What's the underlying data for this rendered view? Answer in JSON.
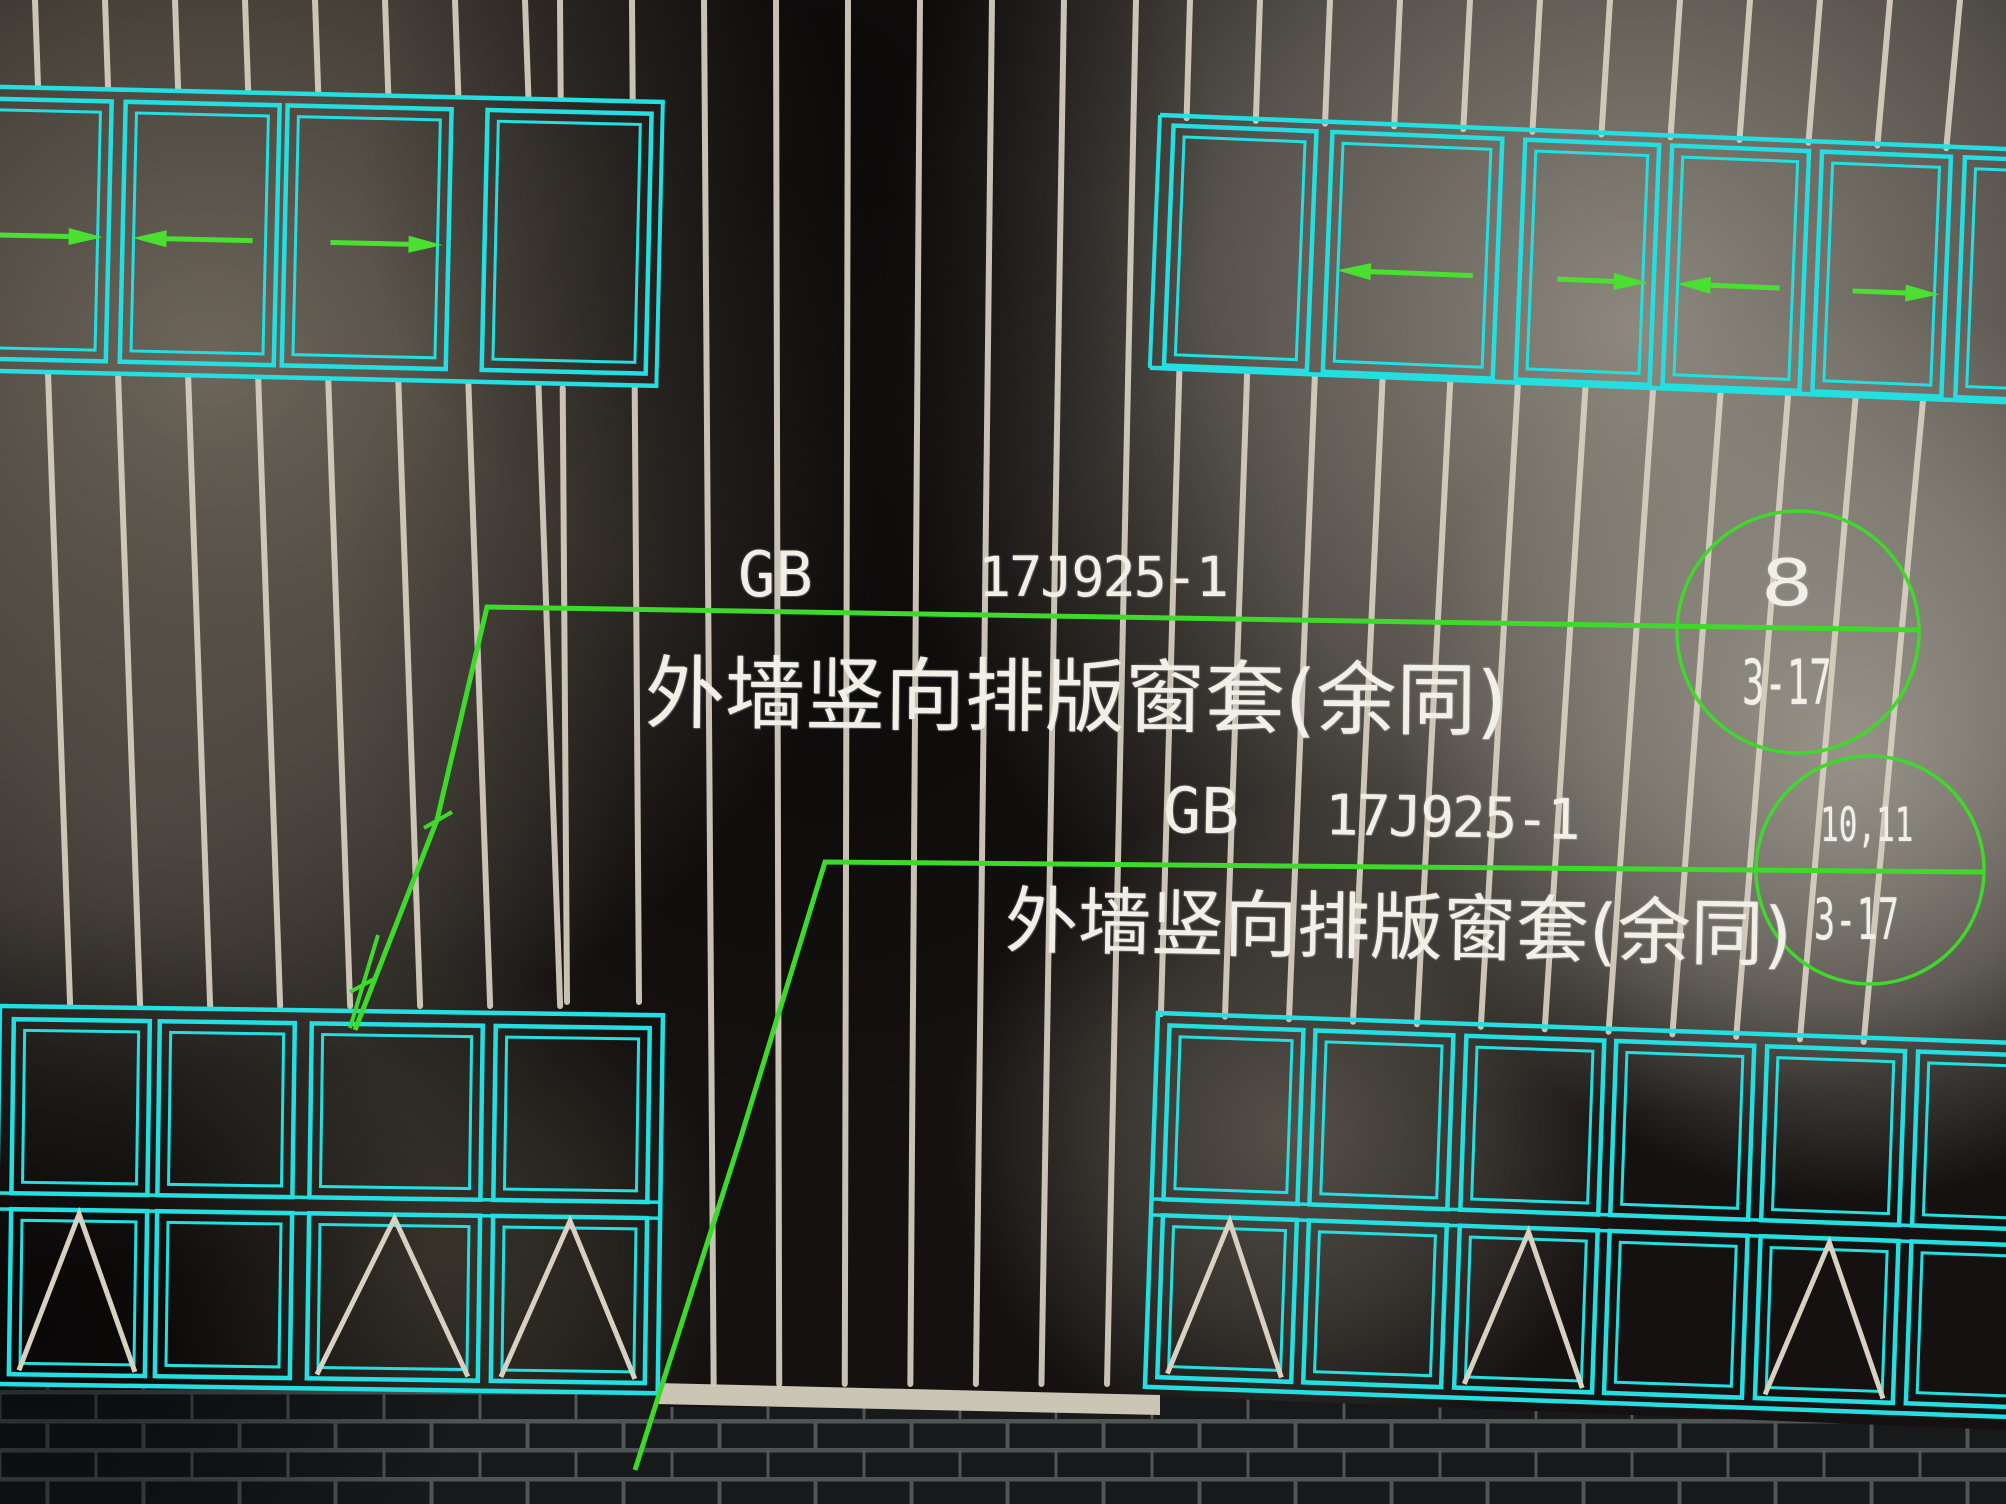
{
  "scene": {
    "kind": "photo-of-cad-screen",
    "subject": "exterior wall window elevation with vertical panel layout and detail callouts"
  },
  "colors": {
    "window_frame": "#23dfe1",
    "leader": "#3fd92b",
    "arrow": "#49e032",
    "panel_joint": "#d8d1c2",
    "text": "#f2efe7",
    "sill_band": "#cbc5b6",
    "brick_face": "#17191b",
    "brick_mortar": "#4f5556"
  },
  "annotations": {
    "callouts": [
      {
        "code_label": "GB",
        "code_number": "17J925-1",
        "description": "外墙竖向排版窗套(余同)",
        "bubble": {
          "top": "8",
          "bottom": "3-17"
        }
      },
      {
        "code_label": "GB",
        "code_number": "17J925-1",
        "description": "外墙竖向排版窗套(余同)",
        "bubble": {
          "top": "10,11",
          "bottom": "3-17"
        }
      }
    ]
  },
  "drawing": {
    "window_groups": [
      {
        "id": "top-left",
        "rows": 1,
        "sash_symbols": [
          "arrow-right",
          "arrow-left",
          "arrow-right",
          "none"
        ]
      },
      {
        "id": "top-right",
        "rows": 1,
        "sash_symbols": [
          "none",
          "arrow-left",
          "arrow-right",
          "arrow-left",
          "arrow-right",
          "none"
        ]
      },
      {
        "id": "bottom-left",
        "rows": 2,
        "upper_sash_symbols": [
          "none",
          "none",
          "none",
          "none"
        ],
        "lower_sash_symbols": [
          "triangle",
          "none",
          "triangle",
          "triangle"
        ]
      },
      {
        "id": "bottom-right",
        "rows": 2,
        "upper_sash_symbols": [
          "none",
          "none",
          "none",
          "none",
          "none",
          "none"
        ],
        "lower_sash_symbols": [
          "triangle",
          "none",
          "triangle",
          "none",
          "triangle",
          "none"
        ]
      }
    ]
  }
}
